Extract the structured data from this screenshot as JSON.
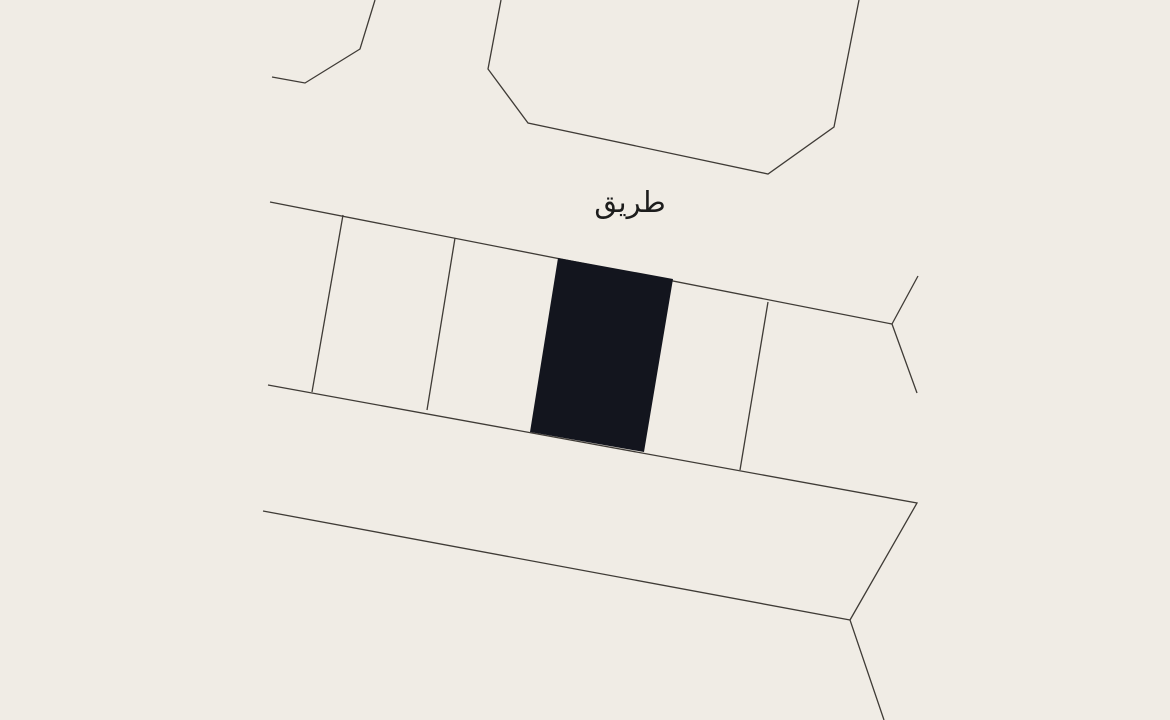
{
  "map": {
    "background_color": "#f0ece5",
    "line_color": "#3f3b36",
    "line_width": 1.3,
    "selected_parcel_fill": "#13151e",
    "label": {
      "text": "طريق",
      "color": "#1c1c1c",
      "x": 630,
      "y": 212,
      "font_size": 29
    },
    "shapes": [
      {
        "name": "block-northwest-boundary",
        "kind": "polyline",
        "interactable": false,
        "points": [
          [
            375,
            0
          ],
          [
            360,
            49
          ],
          [
            305,
            83
          ],
          [
            272,
            77
          ]
        ]
      },
      {
        "name": "block-north-boundary",
        "kind": "polyline",
        "interactable": false,
        "points": [
          [
            501,
            0
          ],
          [
            488,
            69
          ],
          [
            528,
            123
          ],
          [
            768,
            174
          ],
          [
            834,
            127
          ],
          [
            859,
            0
          ]
        ]
      },
      {
        "name": "road-north-edge",
        "kind": "polyline",
        "interactable": false,
        "points": [
          [
            270,
            202
          ],
          [
            892,
            324
          ]
        ]
      },
      {
        "name": "junction-spur-north",
        "kind": "polyline",
        "interactable": false,
        "points": [
          [
            892,
            324
          ],
          [
            918,
            276
          ]
        ]
      },
      {
        "name": "junction-spur-south",
        "kind": "polyline",
        "interactable": false,
        "points": [
          [
            892,
            324
          ],
          [
            917,
            393
          ]
        ]
      },
      {
        "name": "parcel-row-south-edge",
        "kind": "polyline",
        "interactable": false,
        "points": [
          [
            268,
            385
          ],
          [
            917,
            503
          ],
          [
            850,
            620
          ],
          [
            884,
            720
          ]
        ]
      },
      {
        "name": "road-south-edge",
        "kind": "polyline",
        "interactable": false,
        "points": [
          [
            263,
            511
          ],
          [
            850,
            620
          ]
        ]
      },
      {
        "name": "parcel-divider-1",
        "kind": "polyline",
        "interactable": false,
        "points": [
          [
            343,
            215
          ],
          [
            312,
            392
          ]
        ]
      },
      {
        "name": "parcel-divider-2",
        "kind": "polyline",
        "interactable": false,
        "points": [
          [
            455,
            238
          ],
          [
            427,
            410
          ]
        ]
      },
      {
        "name": "parcel-divider-3",
        "kind": "polyline",
        "interactable": false,
        "points": [
          [
            768,
            302
          ],
          [
            740,
            470
          ]
        ]
      },
      {
        "name": "selected-parcel",
        "kind": "polygon",
        "interactable": true,
        "points": [
          [
            558,
            258
          ],
          [
            673,
            279
          ],
          [
            644,
            452
          ],
          [
            530,
            432
          ]
        ]
      }
    ]
  }
}
